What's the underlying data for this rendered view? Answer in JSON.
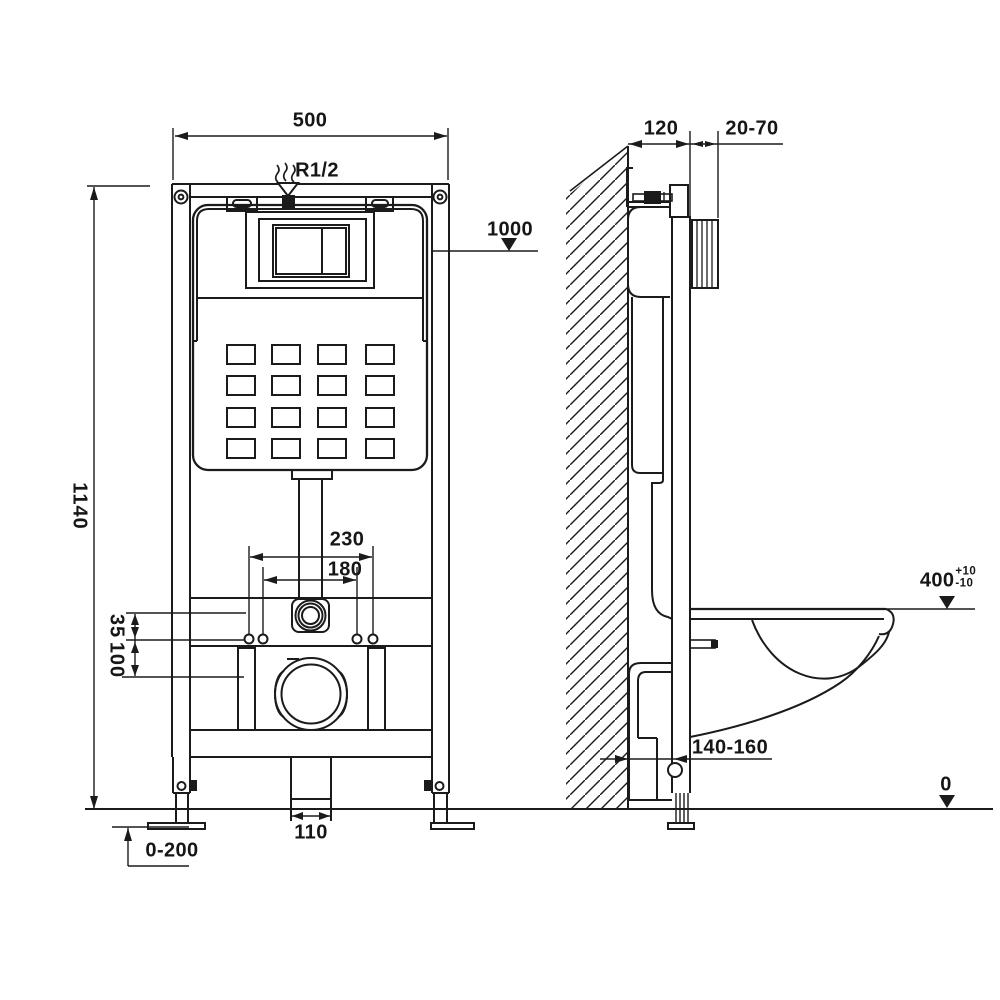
{
  "front_view": {
    "dim_frame_width": "500",
    "inlet_thread": "R1/2",
    "dim_cistern_level": "1000",
    "dim_frame_height": "1140",
    "dim_bolt_spacing_outer": "230",
    "dim_bolt_spacing_inner": "180",
    "dim_offset_upper": "35",
    "dim_offset_lower": "100",
    "dim_drain_width": "110",
    "dim_floor_adjust": "0-200"
  },
  "side_view": {
    "dim_frame_depth": "120",
    "dim_wall_finish": "20-70",
    "dim_seat_height": "400",
    "dim_seat_tol_plus": "+10",
    "dim_seat_tol_minus": "-10",
    "dim_outlet_distance": "140-160",
    "floor_level": "0"
  },
  "colors": {
    "line": "#1b1b1b",
    "background": "#ffffff"
  }
}
